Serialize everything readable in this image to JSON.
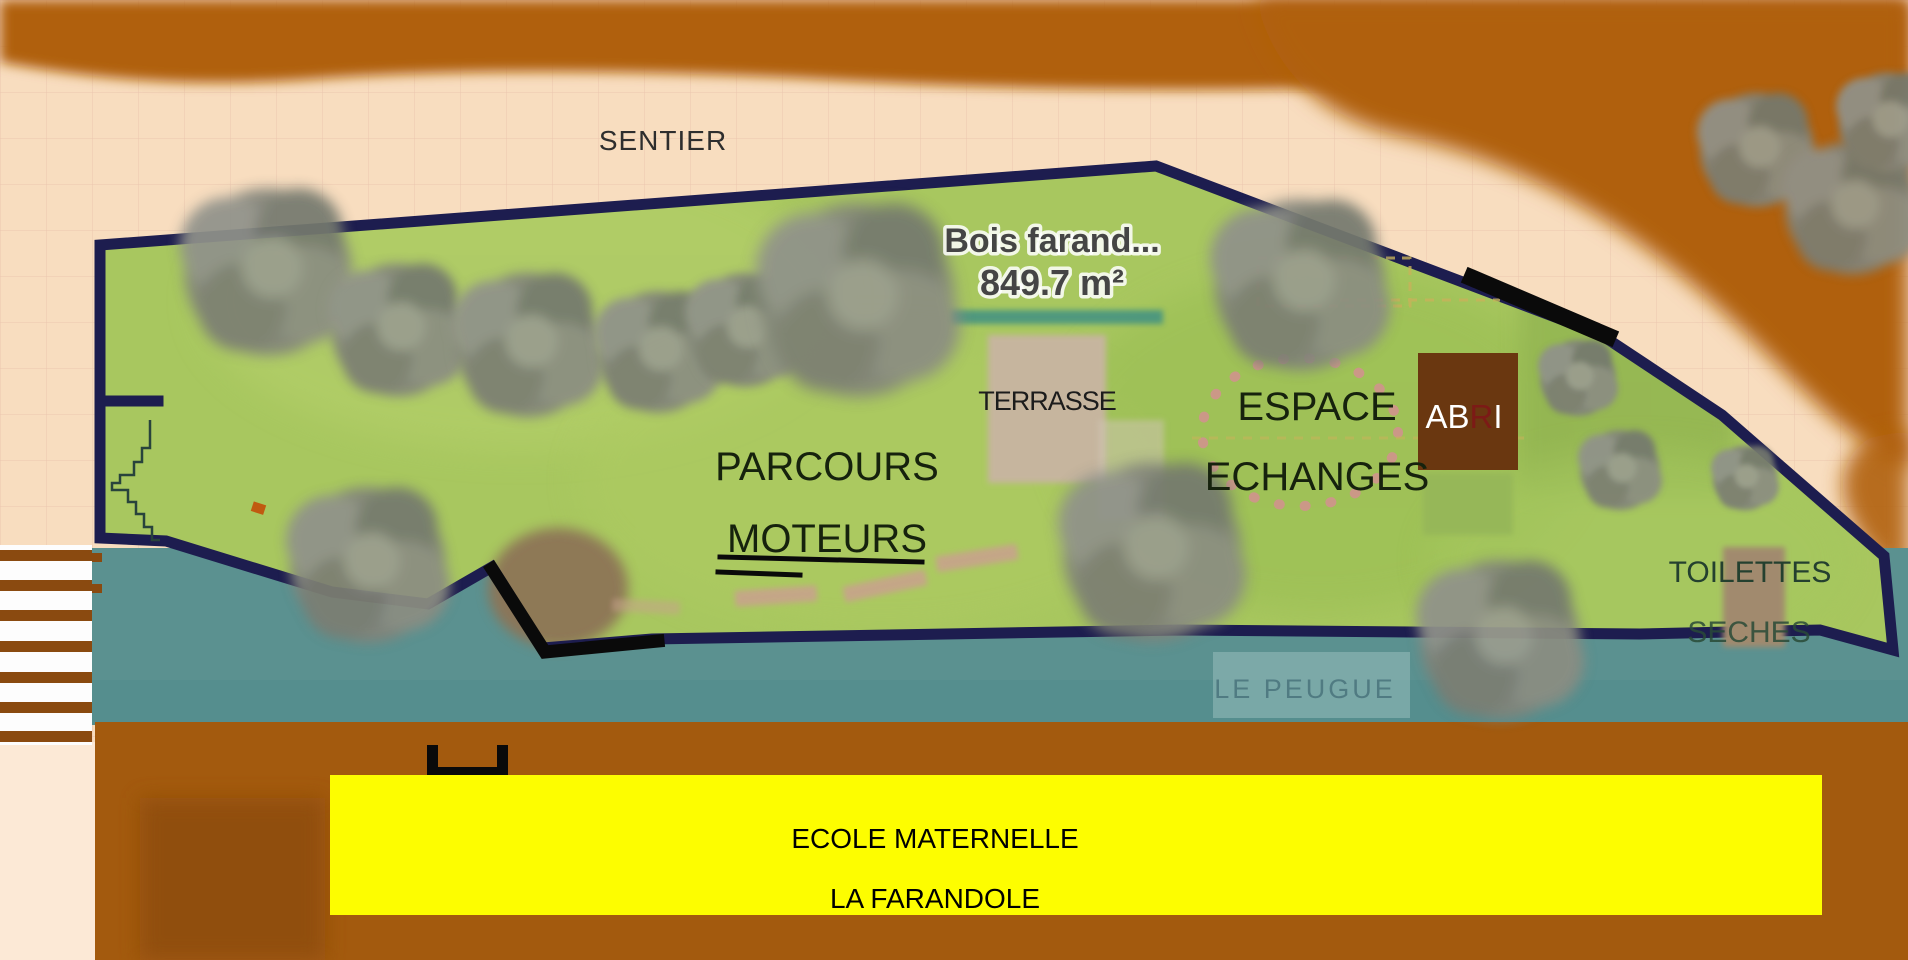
{
  "map": {
    "path_label": "SENTIER",
    "wood": {
      "name": "Bois farand...",
      "area": "849.7 m²"
    },
    "areas": {
      "terrasse": "TERRASSE",
      "parcours_line1": "PARCOURS",
      "parcours_line2": "MOTEURS",
      "espace_line1": "ESPACE",
      "espace_line2": "ECHANGES",
      "abri_part1": "AB",
      "abri_part2": "R",
      "abri_part3": "I",
      "toilettes_line1": "TOILETTES",
      "toilettes_line2": "SECHES"
    },
    "river_label": "LE PEUGUE",
    "banner_line1": "ECOLE MATERNELLE",
    "banner_line2": "LA FARANDOLE",
    "colors": {
      "background_peach": "#f8ddbf",
      "earth_brown": "#ad5f10",
      "grass_green": "#a8c75f",
      "water_teal": "#5b9190",
      "boundary_navy": "#1d1d4f",
      "banner_yellow": "#fdfd00",
      "abri_brown": "#6a3710",
      "terrasse_tan": "#c6b59e",
      "toilettes_tan": "#a18a6e",
      "marker_black": "#0a0a0a"
    }
  }
}
